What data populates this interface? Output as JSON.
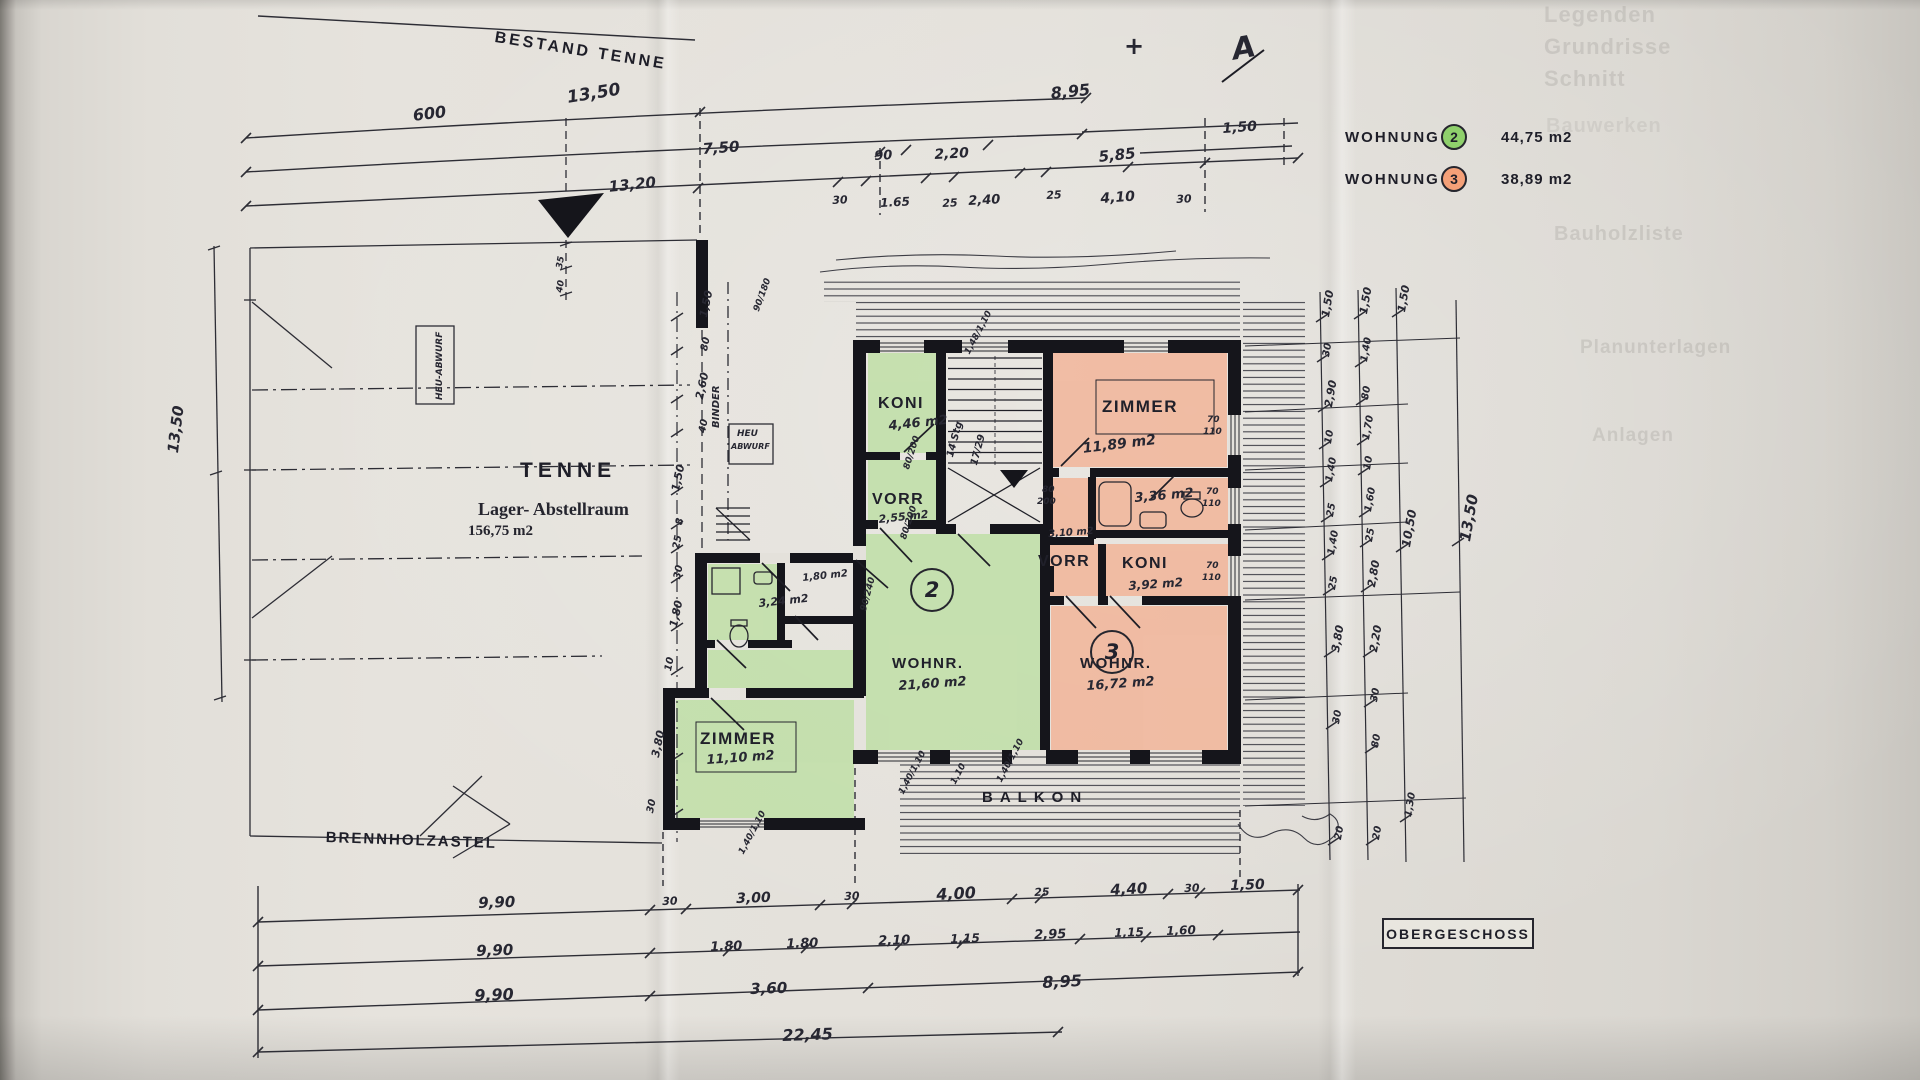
{
  "legend": {
    "rows": [
      {
        "label": "WOHNUNG",
        "unit": "2",
        "area": "44,75 m2",
        "color": "#8fd06c"
      },
      {
        "label": "WOHNUNG",
        "unit": "3",
        "area": "38,89 m2",
        "color": "#f4a078"
      }
    ]
  },
  "titleblock": {
    "label": "OBERGESCHOSS"
  },
  "units": [
    {
      "number": "2"
    },
    {
      "number": "3"
    }
  ],
  "colors": {
    "wohnung2": "#8fd06c",
    "wohnung3": "#f4a078",
    "green_fill": "#bcdfa2",
    "orange_fill": "#f3b193",
    "ink": "#20202a",
    "paper": "#e2dfd9"
  },
  "labels": [
    {
      "t": "BESTAND TENNE",
      "x": 496,
      "y": 30,
      "r": 9,
      "s": 16,
      "c": "ps",
      "n": "title-bestand-tenne"
    },
    {
      "t": "TENNE",
      "x": 520,
      "y": 460,
      "s": 21,
      "c": "ps",
      "ls": 5,
      "n": "room-tenne-name"
    },
    {
      "t": "Lager- Abstellraum",
      "x": 478,
      "y": 500,
      "s": 18,
      "c": "se",
      "n": "room-tenne-subtitle"
    },
    {
      "t": "156,75 m2",
      "x": 468,
      "y": 524,
      "s": 15,
      "c": "se",
      "n": "room-tenne-area"
    },
    {
      "t": "BRENNHOLZASTEL",
      "x": 326,
      "y": 830,
      "r": 2,
      "s": 15,
      "c": "ps",
      "ls": 2,
      "n": "label-brennholzastel"
    },
    {
      "t": "BALKON",
      "x": 982,
      "y": 790,
      "s": 15,
      "c": "ps",
      "ls": 7,
      "n": "label-balkon"
    },
    {
      "t": "HEU-ABWURF",
      "x": 436,
      "y": 400,
      "r": -90,
      "s": 9,
      "c": "h",
      "n": "label-heu-abwurf"
    },
    {
      "t": "HEU",
      "x": 737,
      "y": 430,
      "s": 9,
      "c": "h",
      "n": "label-heu-abwurf-2"
    },
    {
      "t": "ABWURF",
      "x": 731,
      "y": 443,
      "s": 8,
      "c": "h",
      "n": "label-heu-abwurf-2"
    },
    {
      "t": "BINDER",
      "x": 712,
      "y": 428,
      "r": -90,
      "s": 10,
      "c": "h",
      "n": "anno-binder"
    },
    {
      "t": "KONI",
      "x": 878,
      "y": 396,
      "s": 16,
      "c": "p",
      "n": "room-koni2-name"
    },
    {
      "t": "4,46 m2",
      "x": 888,
      "y": 420,
      "r": -6,
      "s": 13,
      "c": "h",
      "n": "room-koni2-area"
    },
    {
      "t": "VORR",
      "x": 872,
      "y": 492,
      "s": 16,
      "c": "p",
      "n": "room-vorr2-name"
    },
    {
      "t": "2,55 m2",
      "x": 878,
      "y": 514,
      "r": -6,
      "s": 11,
      "c": "h",
      "n": "room-vorr2-area"
    },
    {
      "t": "ZIMMER",
      "x": 1102,
      "y": 398,
      "s": 17,
      "c": "p",
      "n": "room-zimmer3-name"
    },
    {
      "t": "11,89 m2",
      "x": 1082,
      "y": 442,
      "r": -7,
      "s": 14,
      "c": "h",
      "n": "room-zimmer3-area"
    },
    {
      "t": "3,36 m2",
      "x": 1134,
      "y": 492,
      "r": -5,
      "s": 13,
      "c": "h",
      "n": "room-bad3-area"
    },
    {
      "t": "3,10 m2",
      "x": 1048,
      "y": 530,
      "r": -4,
      "s": 10,
      "c": "h",
      "n": "room-310-area"
    },
    {
      "t": "VORR",
      "x": 1038,
      "y": 554,
      "s": 16,
      "c": "p",
      "n": "room-vorr3-name"
    },
    {
      "t": "KONI",
      "x": 1122,
      "y": 556,
      "s": 16,
      "c": "p",
      "n": "room-koni3-name"
    },
    {
      "t": "3,92 m2",
      "x": 1128,
      "y": 580,
      "r": -4,
      "s": 12,
      "c": "h",
      "n": "room-koni3-area"
    },
    {
      "t": "WOHNR.",
      "x": 892,
      "y": 656,
      "s": 15,
      "c": "p",
      "n": "room-wohnr2-name"
    },
    {
      "t": "21,60 m2",
      "x": 898,
      "y": 680,
      "r": -4,
      "s": 13,
      "c": "h",
      "n": "room-wohnr2-area"
    },
    {
      "t": "WOHNR.",
      "x": 1080,
      "y": 656,
      "s": 15,
      "c": "p",
      "n": "room-wohnr3-name"
    },
    {
      "t": "16,72 m2",
      "x": 1086,
      "y": 680,
      "r": -4,
      "s": 13,
      "c": "h",
      "n": "room-wohnr3-area"
    },
    {
      "t": "ZIMMER",
      "x": 700,
      "y": 730,
      "s": 17,
      "c": "p",
      "n": "room-zimmer2-name"
    },
    {
      "t": "11,10 m2",
      "x": 706,
      "y": 754,
      "r": -4,
      "s": 13,
      "c": "h",
      "n": "room-zimmer2-area"
    },
    {
      "t": "3,24 m2",
      "x": 758,
      "y": 598,
      "r": -6,
      "s": 11,
      "c": "h",
      "n": "room-bad2-area"
    },
    {
      "t": "1,80 m2",
      "x": 802,
      "y": 574,
      "r": -6,
      "s": 10,
      "c": "h",
      "n": "room-180-area"
    },
    {
      "t": "600",
      "x": 412,
      "y": 108,
      "r": -7,
      "s": 16,
      "c": "h",
      "n": "dim-top"
    },
    {
      "t": "13,50",
      "x": 566,
      "y": 90,
      "r": -9,
      "s": 17,
      "c": "h",
      "n": "dim-top"
    },
    {
      "t": "8,95",
      "x": 1050,
      "y": 86,
      "r": -6,
      "s": 16,
      "c": "h",
      "n": "dim-top"
    },
    {
      "t": "7,50",
      "x": 702,
      "y": 142,
      "r": -4,
      "s": 15,
      "c": "h",
      "n": "dim-top"
    },
    {
      "t": "90",
      "x": 874,
      "y": 150,
      "r": -3,
      "s": 13,
      "c": "h",
      "n": "dim-top"
    },
    {
      "t": "2,20",
      "x": 934,
      "y": 148,
      "r": -3,
      "s": 14,
      "c": "h",
      "n": "dim-top"
    },
    {
      "t": "5,85",
      "x": 1098,
      "y": 150,
      "r": -6,
      "s": 15,
      "c": "h",
      "n": "dim-top"
    },
    {
      "t": "1,50",
      "x": 1222,
      "y": 122,
      "r": -4,
      "s": 14,
      "c": "h",
      "n": "dim-top"
    },
    {
      "t": "13,20",
      "x": 608,
      "y": 180,
      "r": -6,
      "s": 15,
      "c": "h",
      "n": "dim-top"
    },
    {
      "t": "30",
      "x": 832,
      "y": 195,
      "r": -3,
      "s": 11,
      "c": "h",
      "n": "dim-top"
    },
    {
      "t": "1.65",
      "x": 880,
      "y": 197,
      "r": -3,
      "s": 12,
      "c": "h",
      "n": "dim-top"
    },
    {
      "t": "25",
      "x": 942,
      "y": 198,
      "r": -3,
      "s": 11,
      "c": "h",
      "n": "dim-top"
    },
    {
      "t": "2,40",
      "x": 968,
      "y": 195,
      "r": -3,
      "s": 13,
      "c": "h",
      "n": "dim-top"
    },
    {
      "t": "25",
      "x": 1046,
      "y": 190,
      "r": -3,
      "s": 11,
      "c": "h",
      "n": "dim-top"
    },
    {
      "t": "4,10",
      "x": 1100,
      "y": 192,
      "r": -4,
      "s": 14,
      "c": "h",
      "n": "dim-top"
    },
    {
      "t": "30",
      "x": 1176,
      "y": 194,
      "r": -3,
      "s": 11,
      "c": "h",
      "n": "dim-top"
    },
    {
      "t": "9,90",
      "x": 478,
      "y": 896,
      "r": -2,
      "s": 15,
      "c": "h",
      "n": "dim-bottom"
    },
    {
      "t": "30",
      "x": 662,
      "y": 896,
      "r": -2,
      "s": 11,
      "c": "h",
      "n": "dim-bottom"
    },
    {
      "t": "3,00",
      "x": 736,
      "y": 892,
      "r": -2,
      "s": 14,
      "c": "h",
      "n": "dim-bottom"
    },
    {
      "t": "30",
      "x": 844,
      "y": 891,
      "r": -2,
      "s": 11,
      "c": "h",
      "n": "dim-bottom"
    },
    {
      "t": "4,00",
      "x": 936,
      "y": 887,
      "r": -3,
      "s": 16,
      "c": "h",
      "n": "dim-bottom"
    },
    {
      "t": "25",
      "x": 1034,
      "y": 887,
      "r": -2,
      "s": 11,
      "c": "h",
      "n": "dim-bottom"
    },
    {
      "t": "4,40",
      "x": 1110,
      "y": 883,
      "r": -3,
      "s": 15,
      "c": "h",
      "n": "dim-bottom"
    },
    {
      "t": "30",
      "x": 1184,
      "y": 883,
      "r": -2,
      "s": 11,
      "c": "h",
      "n": "dim-bottom"
    },
    {
      "t": "1,50",
      "x": 1230,
      "y": 879,
      "r": -2,
      "s": 14,
      "c": "h",
      "n": "dim-bottom"
    },
    {
      "t": "9,90",
      "x": 476,
      "y": 944,
      "r": -2,
      "s": 15,
      "c": "h",
      "n": "dim-bottom"
    },
    {
      "t": "1.80",
      "x": 710,
      "y": 941,
      "r": -2,
      "s": 13,
      "c": "h",
      "n": "dim-bottom"
    },
    {
      "t": "1.80",
      "x": 786,
      "y": 938,
      "r": -2,
      "s": 13,
      "c": "h",
      "n": "dim-bottom"
    },
    {
      "t": "2,10",
      "x": 878,
      "y": 935,
      "r": -2,
      "s": 13,
      "c": "h",
      "n": "dim-bottom"
    },
    {
      "t": "1,15",
      "x": 950,
      "y": 933,
      "r": -2,
      "s": 12,
      "c": "h",
      "n": "dim-bottom"
    },
    {
      "t": "2,95",
      "x": 1034,
      "y": 929,
      "r": -2,
      "s": 13,
      "c": "h",
      "n": "dim-bottom"
    },
    {
      "t": "1,15",
      "x": 1114,
      "y": 927,
      "r": -2,
      "s": 12,
      "c": "h",
      "n": "dim-bottom"
    },
    {
      "t": "1,60",
      "x": 1166,
      "y": 925,
      "r": -2,
      "s": 12,
      "c": "h",
      "n": "dim-bottom"
    },
    {
      "t": "9,90",
      "x": 474,
      "y": 988,
      "r": -2,
      "s": 16,
      "c": "h",
      "n": "dim-bottom"
    },
    {
      "t": "3,60",
      "x": 750,
      "y": 982,
      "r": -2,
      "s": 15,
      "c": "h",
      "n": "dim-bottom"
    },
    {
      "t": "8,95",
      "x": 1042,
      "y": 975,
      "r": -3,
      "s": 16,
      "c": "h",
      "n": "dim-bottom"
    },
    {
      "t": "22,45",
      "x": 782,
      "y": 1028,
      "r": -2,
      "s": 16,
      "c": "h",
      "n": "dim-bottom"
    },
    {
      "t": "13,50",
      "x": 166,
      "y": 452,
      "r": -83,
      "s": 15,
      "c": "h",
      "n": "dim-left"
    },
    {
      "t": "1,50",
      "x": 698,
      "y": 316,
      "r": -78,
      "s": 11,
      "c": "h",
      "n": "dim-chain"
    },
    {
      "t": "80",
      "x": 700,
      "y": 350,
      "r": -78,
      "s": 10,
      "c": "h",
      "n": "dim-chain"
    },
    {
      "t": "2,60",
      "x": 694,
      "y": 398,
      "r": -78,
      "s": 11,
      "c": "h",
      "n": "dim-chain"
    },
    {
      "t": "40",
      "x": 698,
      "y": 432,
      "r": -78,
      "s": 10,
      "c": "h",
      "n": "dim-chain"
    },
    {
      "t": "1,50",
      "x": 670,
      "y": 490,
      "r": -78,
      "s": 11,
      "c": "h",
      "n": "dim-chain"
    },
    {
      "t": "8",
      "x": 675,
      "y": 524,
      "r": -78,
      "s": 10,
      "c": "h",
      "n": "dim-chain"
    },
    {
      "t": "25",
      "x": 672,
      "y": 548,
      "r": -78,
      "s": 10,
      "c": "h",
      "n": "dim-chain"
    },
    {
      "t": "30",
      "x": 673,
      "y": 578,
      "r": -78,
      "s": 10,
      "c": "h",
      "n": "dim-chain"
    },
    {
      "t": "1,80",
      "x": 668,
      "y": 626,
      "r": -78,
      "s": 11,
      "c": "h",
      "n": "dim-chain"
    },
    {
      "t": "10",
      "x": 664,
      "y": 670,
      "r": -78,
      "s": 10,
      "c": "h",
      "n": "dim-chain"
    },
    {
      "t": "3,80",
      "x": 650,
      "y": 756,
      "r": -78,
      "s": 11,
      "c": "h",
      "n": "dim-chain"
    },
    {
      "t": "30",
      "x": 646,
      "y": 812,
      "r": -78,
      "s": 10,
      "c": "h",
      "n": "dim-chain"
    },
    {
      "t": "1,50",
      "x": 1320,
      "y": 316,
      "r": -80,
      "s": 11,
      "c": "h",
      "n": "dim-right"
    },
    {
      "t": "30",
      "x": 1322,
      "y": 356,
      "r": -80,
      "s": 10,
      "c": "h",
      "n": "dim-right"
    },
    {
      "t": "2,90",
      "x": 1323,
      "y": 406,
      "r": -80,
      "s": 11,
      "c": "h",
      "n": "dim-right"
    },
    {
      "t": "10",
      "x": 1324,
      "y": 443,
      "r": -80,
      "s": 10,
      "c": "h",
      "n": "dim-right"
    },
    {
      "t": "1,40",
      "x": 1325,
      "y": 481,
      "r": -80,
      "s": 10,
      "c": "h",
      "n": "dim-right"
    },
    {
      "t": "25",
      "x": 1326,
      "y": 516,
      "r": -80,
      "s": 10,
      "c": "h",
      "n": "dim-right"
    },
    {
      "t": "1,40",
      "x": 1327,
      "y": 554,
      "r": -80,
      "s": 10,
      "c": "h",
      "n": "dim-right"
    },
    {
      "t": "25",
      "x": 1328,
      "y": 589,
      "r": -80,
      "s": 10,
      "c": "h",
      "n": "dim-right"
    },
    {
      "t": "3,80",
      "x": 1330,
      "y": 651,
      "r": -80,
      "s": 11,
      "c": "h",
      "n": "dim-right"
    },
    {
      "t": "30",
      "x": 1332,
      "y": 723,
      "r": -80,
      "s": 10,
      "c": "h",
      "n": "dim-right"
    },
    {
      "t": "20",
      "x": 1334,
      "y": 839,
      "r": -80,
      "s": 10,
      "c": "h",
      "n": "dim-right"
    },
    {
      "t": "1,50",
      "x": 1358,
      "y": 313,
      "r": -80,
      "s": 11,
      "c": "h",
      "n": "dim-right"
    },
    {
      "t": "1,40",
      "x": 1360,
      "y": 361,
      "r": -80,
      "s": 10,
      "c": "h",
      "n": "dim-right"
    },
    {
      "t": "80",
      "x": 1361,
      "y": 399,
      "r": -80,
      "s": 10,
      "c": "h",
      "n": "dim-right"
    },
    {
      "t": "1,70",
      "x": 1362,
      "y": 439,
      "r": -80,
      "s": 10,
      "c": "h",
      "n": "dim-right"
    },
    {
      "t": "10",
      "x": 1363,
      "y": 469,
      "r": -80,
      "s": 10,
      "c": "h",
      "n": "dim-right"
    },
    {
      "t": "1,60",
      "x": 1364,
      "y": 511,
      "r": -80,
      "s": 10,
      "c": "h",
      "n": "dim-right"
    },
    {
      "t": "25",
      "x": 1365,
      "y": 541,
      "r": -80,
      "s": 10,
      "c": "h",
      "n": "dim-right"
    },
    {
      "t": "2,80",
      "x": 1366,
      "y": 586,
      "r": -80,
      "s": 11,
      "c": "h",
      "n": "dim-right"
    },
    {
      "t": "2,20",
      "x": 1368,
      "y": 651,
      "r": -80,
      "s": 11,
      "c": "h",
      "n": "dim-right"
    },
    {
      "t": "30",
      "x": 1370,
      "y": 701,
      "r": -80,
      "s": 10,
      "c": "h",
      "n": "dim-right"
    },
    {
      "t": "80",
      "x": 1371,
      "y": 747,
      "r": -80,
      "s": 10,
      "c": "h",
      "n": "dim-right"
    },
    {
      "t": "20",
      "x": 1372,
      "y": 839,
      "r": -80,
      "s": 10,
      "c": "h",
      "n": "dim-right"
    },
    {
      "t": "1,50",
      "x": 1396,
      "y": 311,
      "r": -80,
      "s": 11,
      "c": "h",
      "n": "dim-right"
    },
    {
      "t": "10,50",
      "x": 1400,
      "y": 546,
      "r": -80,
      "s": 12,
      "c": "h",
      "n": "dim-right"
    },
    {
      "t": "1,30",
      "x": 1404,
      "y": 816,
      "r": -80,
      "s": 10,
      "c": "h",
      "n": "dim-right"
    },
    {
      "t": "13,50",
      "x": 1458,
      "y": 540,
      "r": -80,
      "s": 15,
      "c": "h",
      "n": "dim-right"
    },
    {
      "t": "80/200",
      "x": 903,
      "y": 468,
      "r": -72,
      "s": 9,
      "c": "h",
      "n": "anno-opening"
    },
    {
      "t": "80/200",
      "x": 900,
      "y": 538,
      "r": -72,
      "s": 9,
      "c": "h",
      "n": "anno-opening"
    },
    {
      "t": "80",
      "x": 1042,
      "y": 486,
      "s": 9,
      "c": "h",
      "n": "anno-opening"
    },
    {
      "t": "200",
      "x": 1037,
      "y": 498,
      "s": 9,
      "c": "h",
      "n": "anno-opening"
    },
    {
      "t": "70",
      "x": 1206,
      "y": 488,
      "s": 9,
      "c": "h",
      "n": "anno-opening"
    },
    {
      "t": "110",
      "x": 1202,
      "y": 500,
      "s": 9,
      "c": "h",
      "n": "anno-opening"
    },
    {
      "t": "70",
      "x": 1206,
      "y": 562,
      "s": 9,
      "c": "h",
      "n": "anno-opening"
    },
    {
      "t": "110",
      "x": 1202,
      "y": 574,
      "s": 9,
      "c": "h",
      "n": "anno-opening"
    },
    {
      "t": "70",
      "x": 1207,
      "y": 416,
      "s": 9,
      "c": "h",
      "n": "anno-opening"
    },
    {
      "t": "110",
      "x": 1203,
      "y": 428,
      "s": 9,
      "c": "h",
      "n": "anno-opening"
    },
    {
      "t": "90/240",
      "x": 860,
      "y": 610,
      "r": -75,
      "s": 9,
      "c": "h",
      "n": "anno-opening"
    },
    {
      "t": "1,40/1,10",
      "x": 738,
      "y": 852,
      "r": -62,
      "s": 9,
      "c": "h",
      "n": "anno-window"
    },
    {
      "t": "1,40/1,10",
      "x": 898,
      "y": 792,
      "r": -62,
      "s": 9,
      "c": "h",
      "n": "anno-window"
    },
    {
      "t": "1,10",
      "x": 950,
      "y": 782,
      "r": -62,
      "s": 9,
      "c": "h",
      "n": "anno-window"
    },
    {
      "t": "1,40/1,10",
      "x": 996,
      "y": 780,
      "r": -62,
      "s": 9,
      "c": "h",
      "n": "anno-window"
    },
    {
      "t": "1,48/1,10",
      "x": 964,
      "y": 352,
      "r": -62,
      "s": 9,
      "c": "h",
      "n": "anno-window"
    },
    {
      "t": "90/180",
      "x": 753,
      "y": 310,
      "r": -70,
      "s": 9,
      "c": "h",
      "n": "anno-window"
    },
    {
      "t": "14 Stg",
      "x": 946,
      "y": 456,
      "r": -75,
      "s": 10,
      "c": "h",
      "n": "anno-stairs"
    },
    {
      "t": "17/29",
      "x": 970,
      "y": 464,
      "r": -75,
      "s": 10,
      "c": "h",
      "n": "anno-stairs"
    },
    {
      "t": "35",
      "x": 556,
      "y": 268,
      "r": -80,
      "s": 9,
      "c": "h",
      "n": "anno-tick"
    },
    {
      "t": "40",
      "x": 556,
      "y": 292,
      "r": -80,
      "s": 9,
      "c": "h",
      "n": "anno-tick"
    },
    {
      "t": "A",
      "x": 1230,
      "y": 36,
      "r": -10,
      "s": 30,
      "c": "h",
      "n": "north-marker-a"
    },
    {
      "t": "+",
      "x": 1124,
      "y": 34,
      "s": 24,
      "c": "h",
      "n": "cross-marker"
    },
    {
      "t": "Legenden",
      "x": 1544,
      "y": 4,
      "s": 22,
      "c": "g",
      "n": "watermark"
    },
    {
      "t": "Grundrisse",
      "x": 1544,
      "y": 36,
      "s": 22,
      "c": "g",
      "n": "watermark"
    },
    {
      "t": "Schnitt",
      "x": 1544,
      "y": 68,
      "s": 22,
      "c": "g",
      "n": "watermark"
    },
    {
      "t": "Bauwerken",
      "x": 1546,
      "y": 116,
      "s": 20,
      "o": 0.16,
      "c": "g",
      "n": "watermark"
    },
    {
      "t": "Bauholzliste",
      "x": 1554,
      "y": 224,
      "s": 20,
      "c": "g",
      "n": "watermark"
    },
    {
      "t": "Planunterlagen",
      "x": 1580,
      "y": 338,
      "s": 19,
      "c": "g",
      "n": "watermark"
    },
    {
      "t": "Anlagen",
      "x": 1592,
      "y": 426,
      "s": 19,
      "c": "g",
      "n": "watermark"
    }
  ]
}
